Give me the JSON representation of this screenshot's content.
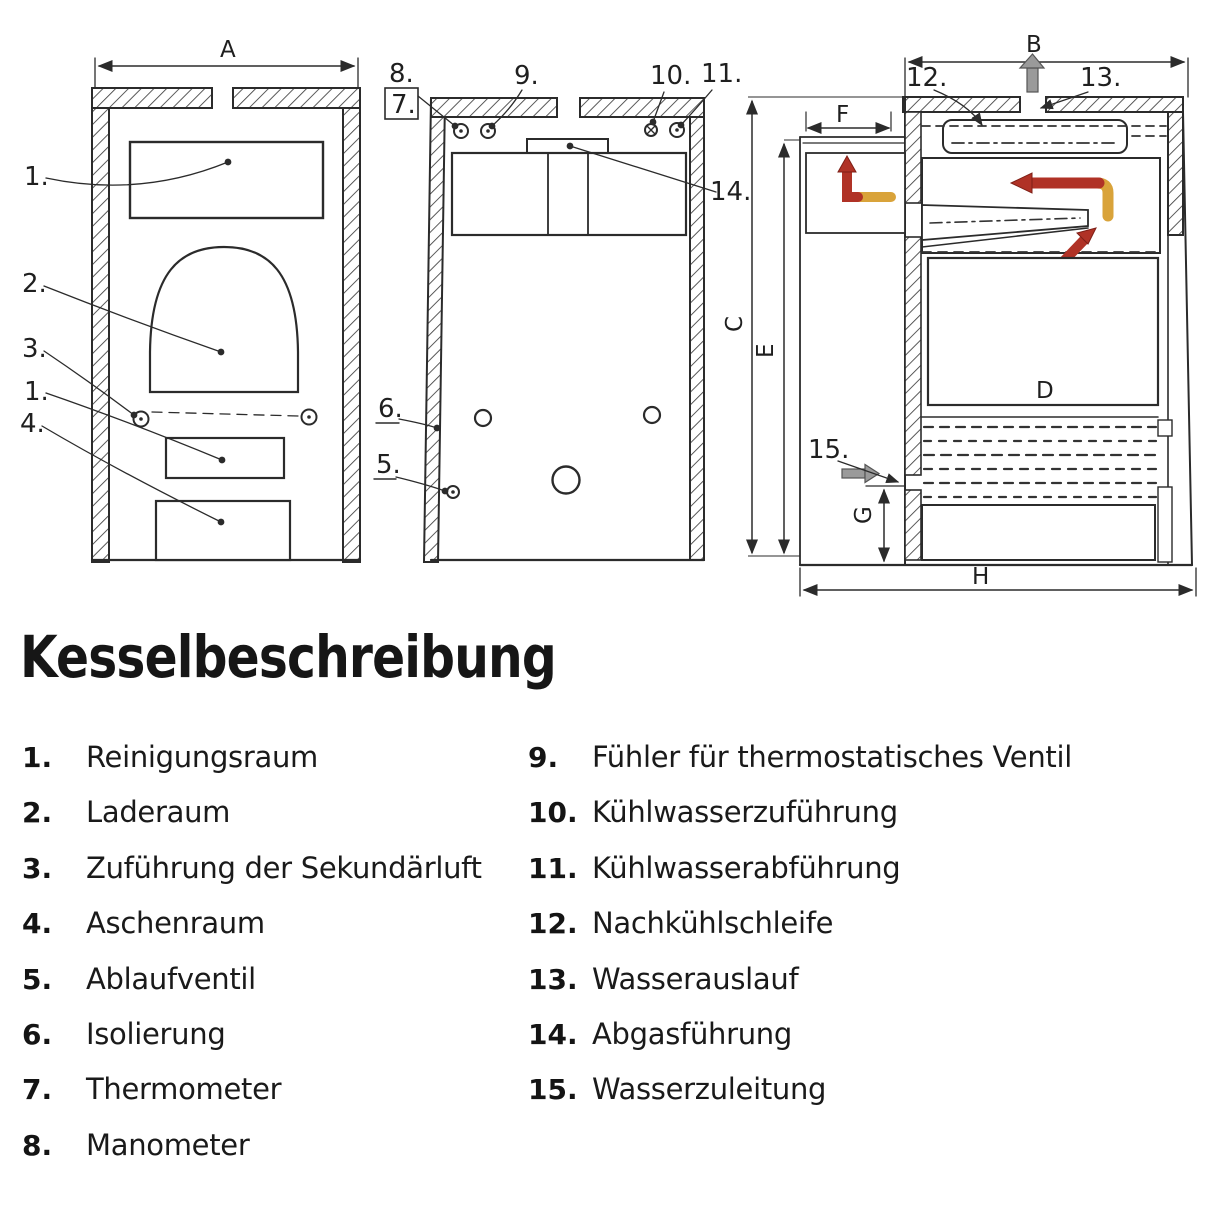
{
  "title": "Kesselbeschreibung",
  "legend": {
    "left": [
      {
        "num": "1.",
        "label": "Reinigungsraum"
      },
      {
        "num": "2.",
        "label": "Laderaum"
      },
      {
        "num": "3.",
        "label": "Zuführung der Sekundärluft"
      },
      {
        "num": "4.",
        "label": "Aschenraum"
      },
      {
        "num": "5.",
        "label": "Ablaufventil"
      },
      {
        "num": "6.",
        "label": "Isolierung"
      },
      {
        "num": "7.",
        "label": "Thermometer"
      },
      {
        "num": "8.",
        "label": "Manometer"
      }
    ],
    "right": [
      {
        "num": "9.",
        "label": "Fühler für thermostatisches Ventil"
      },
      {
        "num": "10.",
        "label": "Kühlwasserzuführung"
      },
      {
        "num": "11.",
        "label": "Kühlwasserabführung"
      },
      {
        "num": "12.",
        "label": "Nachkühlschleife"
      },
      {
        "num": "13.",
        "label": "Wasserauslauf"
      },
      {
        "num": "14.",
        "label": "Abgasführung"
      },
      {
        "num": "15.",
        "label": "Wasserzuleitung"
      }
    ]
  },
  "diagram": {
    "dimensions": {
      "a": "A",
      "b": "B",
      "c": "C",
      "d": "D",
      "e": "E",
      "f": "F",
      "g": "G",
      "h": "H"
    },
    "front_view": {
      "callouts": [
        "1.",
        "2.",
        "3.",
        "1.",
        "4."
      ]
    },
    "rear_view": {
      "callouts": [
        "8.",
        "7.",
        "9.",
        "10.",
        "11.",
        "14.",
        "6.",
        "5."
      ]
    },
    "side_view": {
      "callouts": [
        "12.",
        "13.",
        "15."
      ]
    },
    "colors": {
      "hot_flow": "#b03226",
      "warm_flow": "#d9a33a",
      "water_flow": "#9a9a9a",
      "line": "#2b2b2b"
    }
  }
}
